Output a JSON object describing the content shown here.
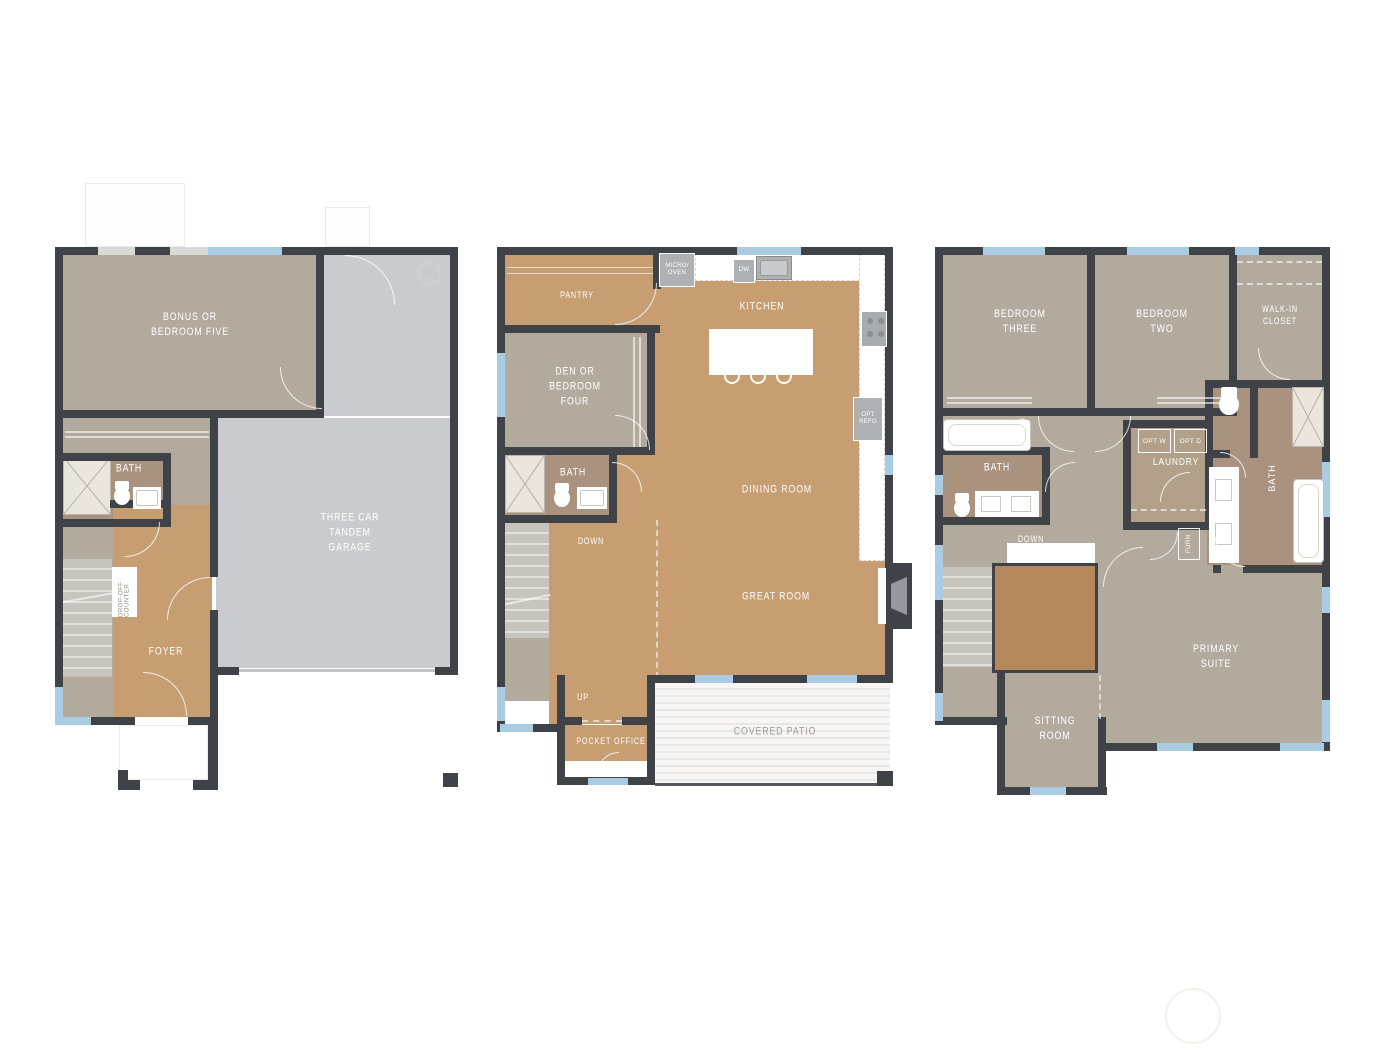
{
  "document": {
    "type": "three-level residential floor plan sheet",
    "background": "#ffffff"
  },
  "colors": {
    "wall": "#3f4347",
    "room_taupe": "#b2aa9d",
    "room_brown": "#c79d72",
    "room_bath": "#a9937f",
    "room_laundry": "#b2a08b",
    "garage_gray": "#c9cbce",
    "stair_opening_brown": "#b5885b",
    "window_blue": "#a9cce3",
    "label_white": "#ffffff",
    "patio_label_gray": "#9b9b99"
  },
  "plans": {
    "lower": {
      "labels": {
        "bonus": "BONUS OR\nBEDROOM FIVE",
        "bath": "BATH",
        "garage": "THREE CAR\nTANDEM GARAGE",
        "foyer": "FOYER",
        "drop_off": "DROP-OFF\nCOUNTER",
        "water_heater": "WH"
      }
    },
    "main": {
      "labels": {
        "pantry": "PANTRY",
        "micro_oven": "MICRO/\nOVEN",
        "dishwasher": "DW",
        "kitchen": "KITCHEN",
        "den": "DEN OR\nBEDROOM\nFOUR",
        "bath": "BATH",
        "down": "DOWN",
        "dining": "DINING ROOM",
        "opt_refg": "OPT\nREFG",
        "great": "GREAT ROOM",
        "up": "UP",
        "pocket_office": "POCKET OFFICE",
        "covered_patio": "COVERED PATIO"
      }
    },
    "upper": {
      "labels": {
        "bedroom_three": "BEDROOM\nTHREE",
        "bedroom_two": "BEDROOM\nTWO",
        "walk_in_closet": "WALK-IN\nCLOSET",
        "linen": "LINEN",
        "bath_hall": "BATH",
        "opt_washer": "OPT W",
        "opt_dryer": "OPT D",
        "laundry": "LAUNDRY",
        "bath_primary": "BATH",
        "down": "DOWN",
        "furnace": "FURN",
        "primary_suite": "PRIMARY\nSUITE",
        "sitting_room": "SITTING\nROOM"
      }
    }
  }
}
